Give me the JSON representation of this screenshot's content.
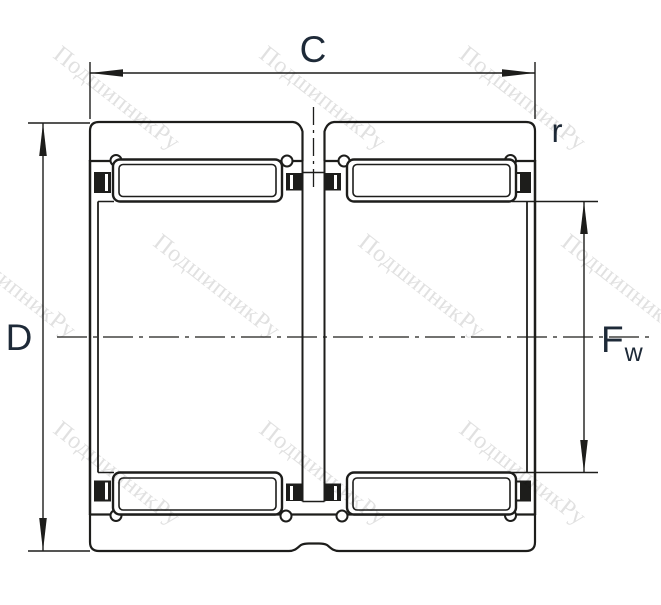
{
  "labels": {
    "width": "C",
    "outer_diameter": "D",
    "chamfer_radius": "r",
    "bore_diameter_main": "F",
    "bore_diameter_sub": "w"
  },
  "watermark": {
    "text": "ПодшипникРу"
  },
  "colors": {
    "line": "#1d1d1b",
    "label": "#1e2a38",
    "watermark": "#c8c8c8",
    "background": "#ffffff"
  }
}
